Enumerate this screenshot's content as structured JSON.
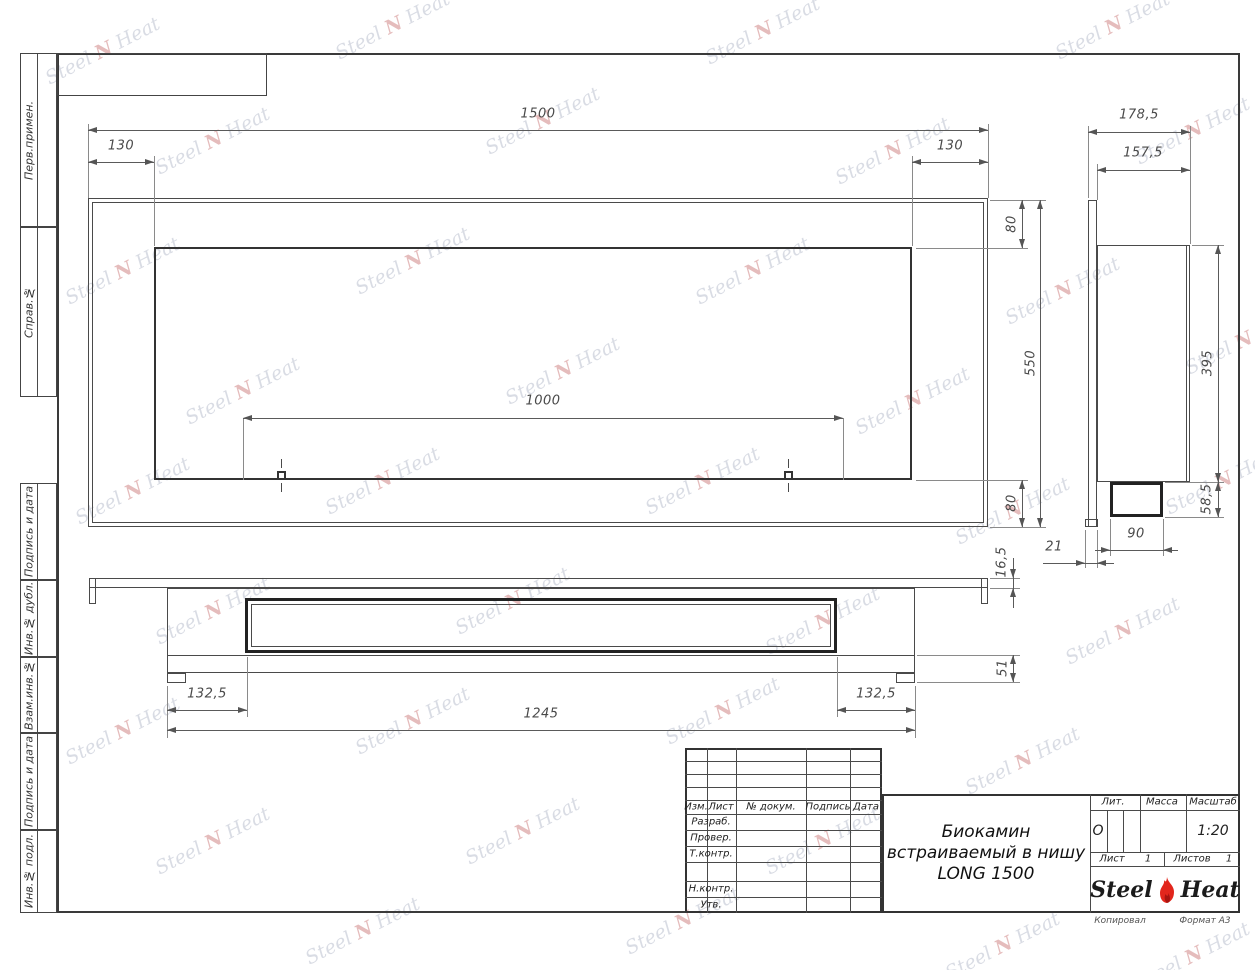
{
  "watermark": {
    "word1": "Steel",
    "word2": "Heat",
    "mark": "N"
  },
  "side_labels": [
    "Перв.примен.",
    "Справ.№",
    "Подпись и дата",
    "Инв.№ дубл.",
    "Взам.инв.№",
    "Подпись и дата",
    "Инв.№ подл."
  ],
  "dimensions": {
    "front": {
      "width": "1500",
      "left_inset": "130",
      "right_inset": "130",
      "top_inset": "80",
      "height": "550",
      "bottom_inset": "80",
      "opening_width": "1000"
    },
    "side": {
      "depth": "178,5",
      "niche_depth": "157,5",
      "niche_height": "395",
      "box_height": "58,5",
      "box_width": "90",
      "flange_thickness": "21"
    },
    "bottom": {
      "flange_thickness": "16,5",
      "bottom_height": "51",
      "left_inset": "132,5",
      "right_inset": "132,5",
      "body_length": "1245"
    }
  },
  "title_block": {
    "title_line1": "Биокамин",
    "title_line2": "встраиваемый в нишу",
    "title_line3": "LONG 1500",
    "rev_headers": {
      "izm": "Изм.",
      "list": "Лист",
      "doc": "№ докум.",
      "sign": "Подпись",
      "date": "Дата"
    },
    "rev_rows": {
      "razrab": "Разраб.",
      "prover": "Провер.",
      "tkontr": "Т.контр.",
      "nkontr": "Н.контр.",
      "utv": "Утв."
    },
    "lit_label": "Лит.",
    "lit_value": "О",
    "mass_label": "Масса",
    "scale_label": "Масштаб",
    "scale_value": "1:20",
    "sheet_label": "Лист",
    "sheet_value": "1",
    "sheets_label": "Листов",
    "sheets_value": "1",
    "logo_steel": "Steel",
    "logo_heat": "Heat",
    "copied_label": "Копировал",
    "format_label": "Формат А3"
  },
  "colors": {
    "line": "#4a4a4a",
    "flame_red": "#e2261c",
    "flame_dark": "#a81410",
    "watermark": "#808ca5"
  }
}
